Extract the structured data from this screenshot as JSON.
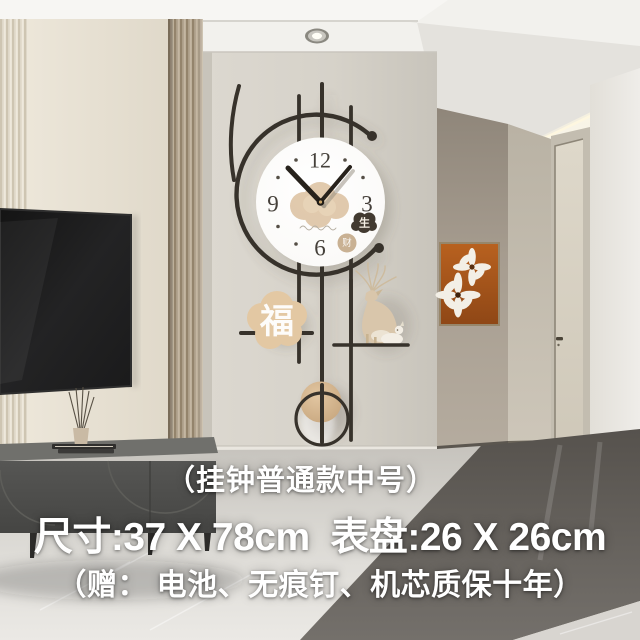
{
  "product_overlay": {
    "line1": "（挂钟普通款中号）",
    "line2": "尺寸:37 X 78cm  表盘:26 X 26cm",
    "line3": "（赠： 电池、无痕钉、机芯质保十年）"
  },
  "clock": {
    "numeral_12": "12",
    "numeral_3": "3",
    "numeral_6": "6",
    "numeral_9": "9",
    "sheng_badge": "生",
    "seal_glyph": "财",
    "fu_plaque": "福",
    "time_shown": "10:08"
  },
  "palette": {
    "clock_metal": "#37322b",
    "clock_face": "#ffffff",
    "clock_beige": "#dcc09c",
    "plaque_beige": "#e3c8a3",
    "art_rust": "#b05a1e",
    "taupe_wall": "#a89f92",
    "cabinet_gray": "#4d4d4b",
    "overlay_text": "#ffffff"
  }
}
